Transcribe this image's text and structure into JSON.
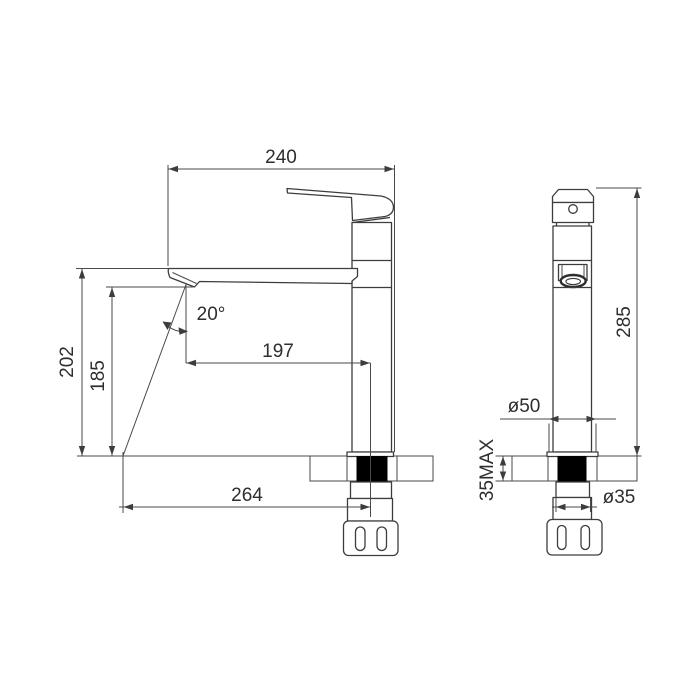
{
  "drawing": {
    "colors": {
      "line": "#3d3d3d",
      "background": "#ffffff",
      "shank_fill": "#000000"
    },
    "dimensions": {
      "top_width": "240",
      "spout_top_height": "202",
      "spout_outlet_height": "185",
      "stream_angle": "20°",
      "outlet_to_axis_distance": "197",
      "overall_reach": "264",
      "overall_height": "285",
      "body_base_diameter": "ø50",
      "max_deck_thickness": "35MAX",
      "shank_diameter": "ø35"
    }
  }
}
